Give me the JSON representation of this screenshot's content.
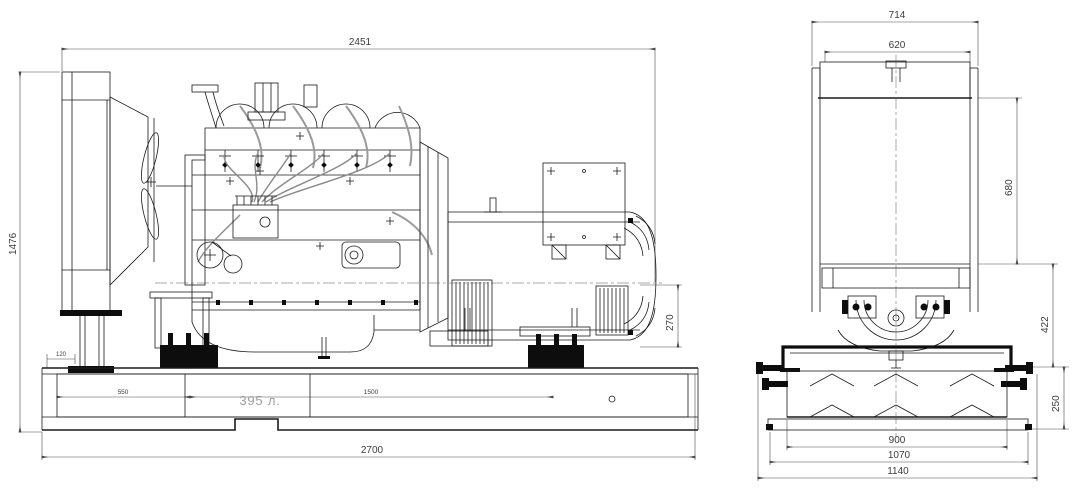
{
  "side_view": {
    "dims": {
      "length_top": "2451",
      "height_overall": "1476",
      "base_length": "2700",
      "rear_duct_height": "270",
      "tank_seg_1": "550",
      "tank_seg_2": "1500",
      "radiator_leg_offset": "120"
    },
    "fuel_tank_capacity": "395 л."
  },
  "front_view": {
    "dims": {
      "width_overall": "714",
      "radiator_width": "620",
      "radiator_core_height": "680",
      "mid_section_height": "422",
      "base_tank_height": "250",
      "tank_width": "900",
      "plate_width": "1070",
      "base_width_overall": "1140"
    }
  },
  "colors": {
    "line": "#1a1a1a",
    "dimension": "#4a4a4a",
    "pipe_gray": "#8a8a8a",
    "capacity_text": "#9e9e9e"
  }
}
